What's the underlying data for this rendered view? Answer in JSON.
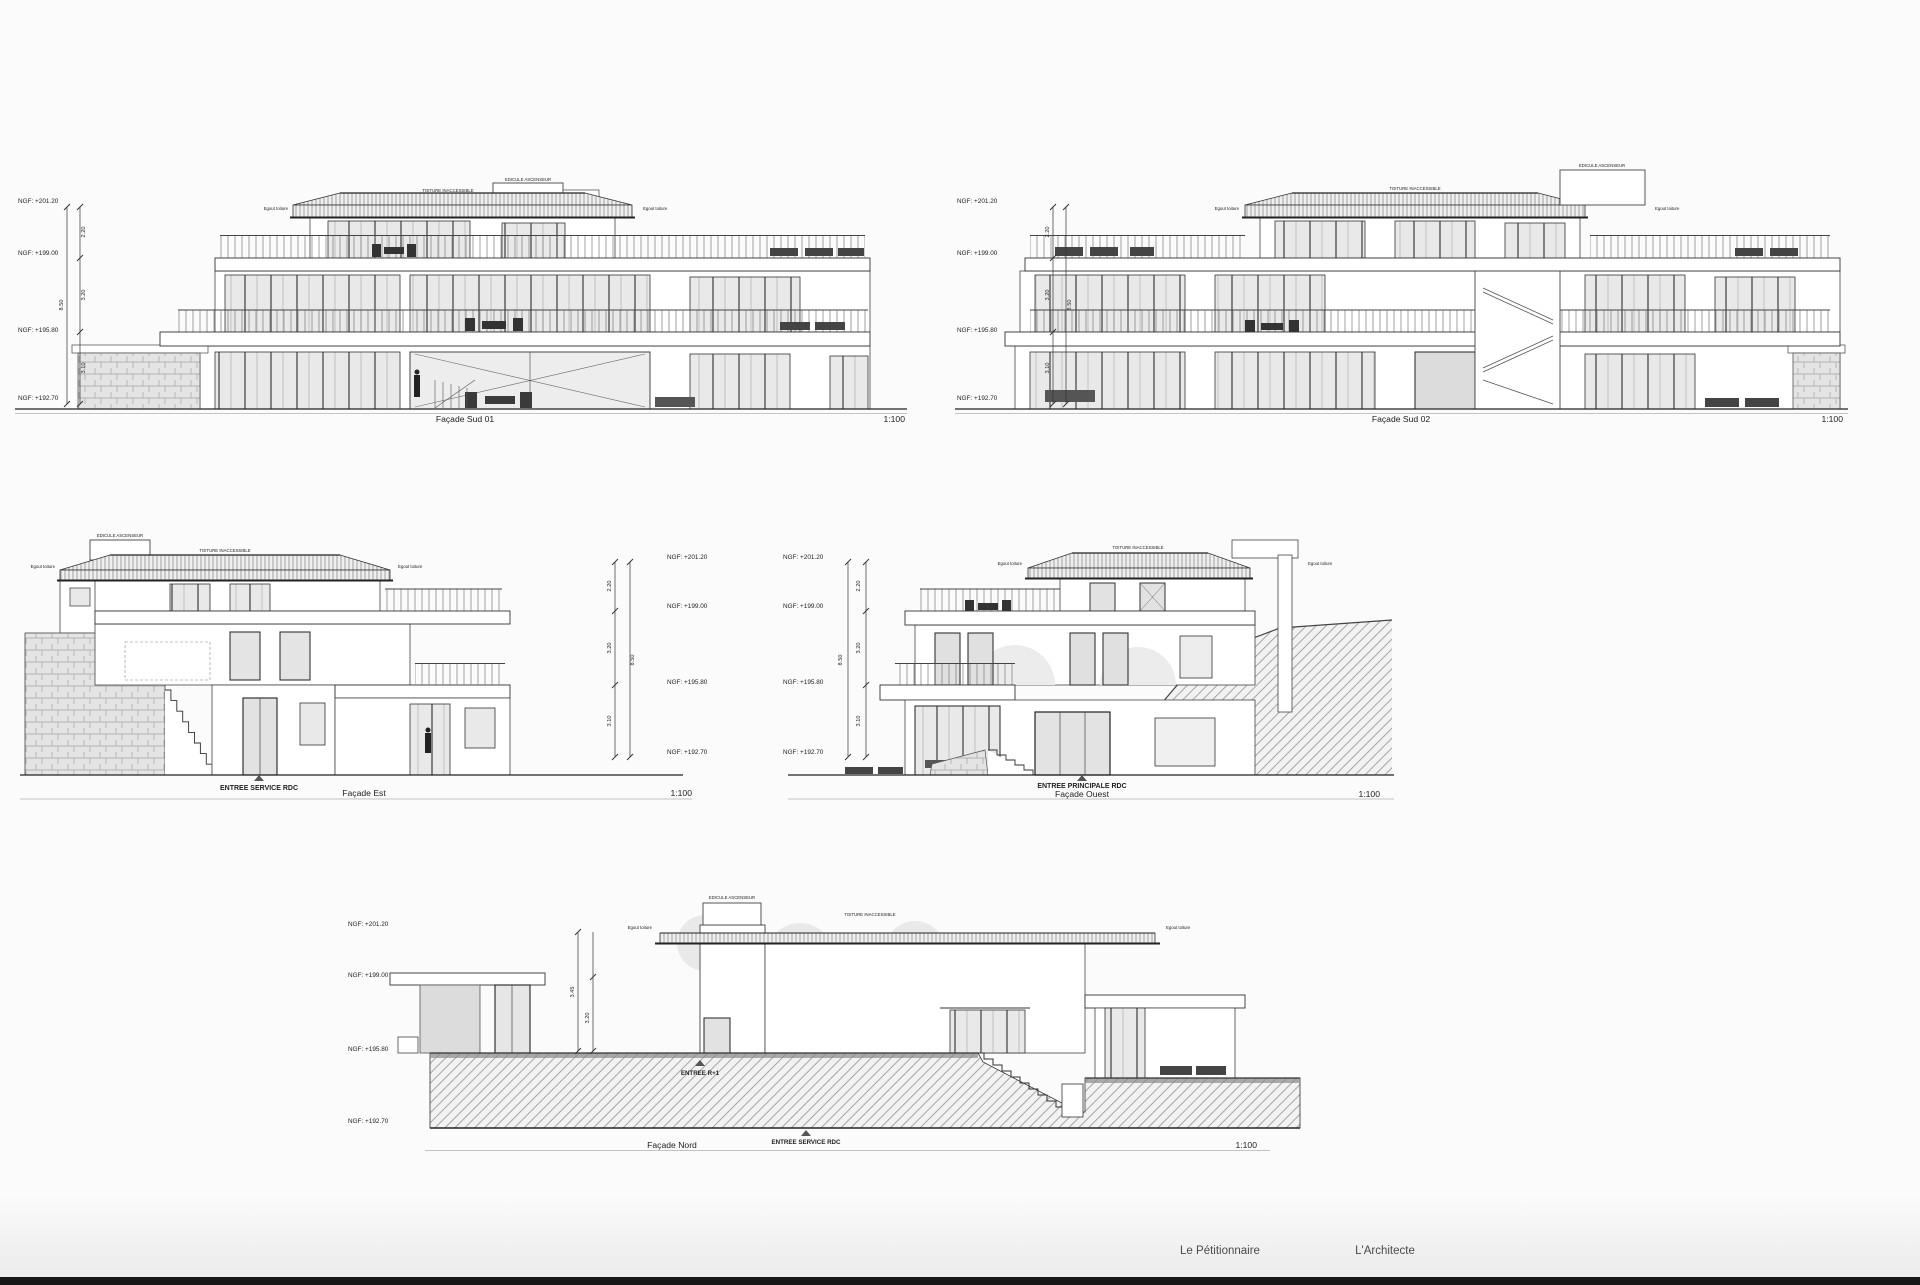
{
  "drawings": [
    {
      "title": "Façade Sud 01",
      "scale": "1:100",
      "ngf": [
        "NGF: +201.20",
        "NGF: +199.00",
        "NGF: +195.80",
        "NGF: +192.70"
      ],
      "dims": {
        "segments": [
          "2.20",
          "3.20",
          "3.10"
        ],
        "total": "8.50"
      },
      "labels": {
        "roof": "TOITURE INACCESSIBLE",
        "shaft": "EDICULE ASCENSEUR",
        "eave_left": "Egout toiture",
        "eave_right": "Egout toiture"
      }
    },
    {
      "title": "Façade Sud 02",
      "scale": "1:100",
      "ngf": [
        "NGF: +201.20",
        "NGF: +199.00",
        "NGF: +195.80",
        "NGF: +192.70"
      ],
      "dims": {
        "segments": [
          "2.20",
          "3.20",
          "3.10"
        ],
        "total": "8.50"
      },
      "labels": {
        "roof": "TOITURE INACCESSIBLE",
        "shaft": "EDICULE ASCENSEUR",
        "eave_left": "Egout toiture",
        "eave_right": "Egout toiture"
      }
    },
    {
      "title": "Façade Est",
      "scale": "1:100",
      "entry": "ENTREE SERVICE RDC",
      "ngf": [
        "NGF: +201.20",
        "NGF: +199.00",
        "NGF: +195.80",
        "NGF: +192.70"
      ],
      "dims": {
        "segments": [
          "2.20",
          "3.20",
          "3.10"
        ],
        "total": "8.50"
      },
      "labels": {
        "roof": "TOITURE INACCESSIBLE",
        "shaft": "EDICULE ASCENSEUR",
        "eave_left": "Egout toiture",
        "eave_right": "Egout toiture"
      }
    },
    {
      "title": "Façade Ouest",
      "scale": "1:100",
      "entry": "ENTREE PRINCIPALE RDC",
      "ngf": [
        "NGF: +201.20",
        "NGF: +199.00",
        "NGF: +195.80",
        "NGF: +192.70"
      ],
      "dims": {
        "segments": [
          "2.20",
          "3.20",
          "3.10"
        ],
        "total": "8.50"
      },
      "labels": {
        "roof": "TOITURE INACCESSIBLE",
        "eave_left": "Egout toiture",
        "eave_right": "Egout toiture"
      }
    },
    {
      "title": "Façade Nord",
      "scale": "1:100",
      "entries": {
        "upper": "ENTREE R+1",
        "service": "ENTREE SERVICE RDC"
      },
      "ngf": [
        "NGF: +201.20",
        "NGF: +199.00",
        "NGF: +195.80",
        "NGF: +192.70"
      ],
      "dims": {
        "segments": [
          "3.45",
          "3.20"
        ]
      },
      "labels": {
        "roof": "TOITURE INACCESSIBLE",
        "shaft": "EDICULE ASCENSEUR",
        "eave_left": "Egout toiture",
        "eave_right": "Egout toiture"
      }
    }
  ],
  "footer": {
    "petitioner_label": "Le Pétitionnaire",
    "architect_label": "L'Architecte"
  }
}
